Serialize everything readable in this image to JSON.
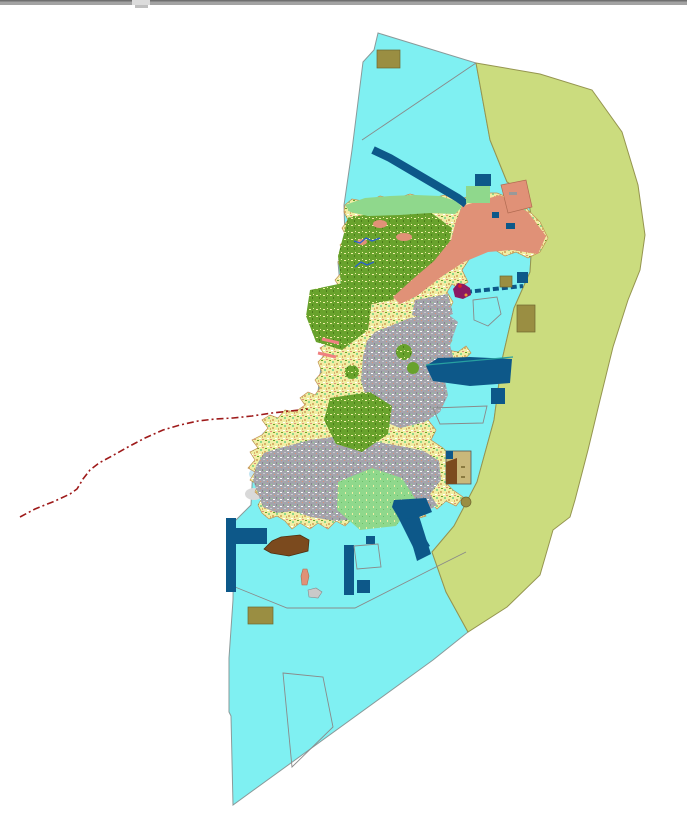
{
  "window": {
    "top_bar": {
      "bar_color": "#a3a3a3",
      "edge_color": "#6f6f6f",
      "notch_color": "#dcdcdc",
      "thumb_color": "#c0c0c0"
    }
  },
  "map": {
    "type": "land-use-map",
    "colors": {
      "background": "#ffffff",
      "water": "#7ff0f2",
      "water_border": "#8a9a9a",
      "outer_zone": "#cbdc7e",
      "outer_zone_border": "#95954f",
      "island_base": "#f1eea4",
      "island_border": "#c09050",
      "forest": "#68a22c",
      "forest_dark": "#4c7d1a",
      "urban": "#a4a4ac",
      "urban_dark": "#888890",
      "urban_light": "#c9c9cf",
      "meadow": "#8fd88c",
      "meadow_dark": "#6cbf69",
      "salmon": "#e09177",
      "salmon_border": "#b06a50",
      "navy": "#0d5889",
      "teal_line": "#27a0a0",
      "khaki_marker": "#9a8e42",
      "khaki_border": "#6e6530",
      "brown": "#7b4a1e",
      "brown_border": "#4f2f10",
      "tan": "#c9b87a",
      "red_route": "#9e1a1a",
      "river_blue": "#2a5fd0",
      "pink_marker": "#f08080",
      "magenta_port": "#8b1a62",
      "red_dot": "#e02020",
      "orange_dot": "#f0a030",
      "boundary_line": "#8a8a8a",
      "parcel_line": "#d8b26a",
      "islet_gray": "#c9c9c9",
      "cove_blue": "#c6e6f2",
      "cove_gray": "#d9d9d9"
    }
  }
}
